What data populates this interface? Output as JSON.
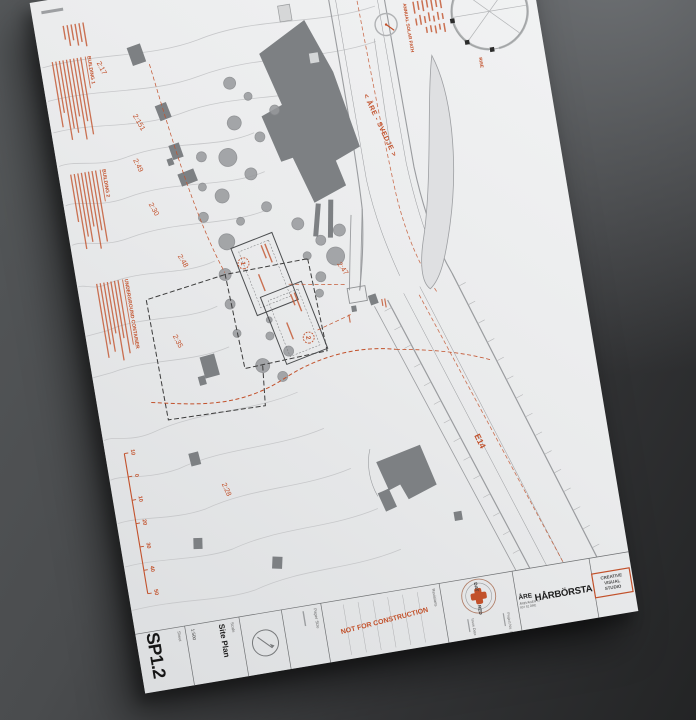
{
  "sheet": {
    "studio_stamp_line1": "CREATIVE",
    "studio_stamp_line2": "VISUAL",
    "studio_stamp_line3": "STUDIO",
    "project_city": "ÅRE",
    "project_name": "HÅRBÖRSTA",
    "address_line1": "ÅREVÄGEN 57",
    "address_line2": "837 52 ÅRE",
    "logo_left": "DAT",
    "logo_right": "RED",
    "project_no_label": "Project No. 1",
    "issue_date_label": "Issue Date",
    "revisions_label": "Revisions",
    "construction_stamp": "NOT FOR CONSTRUCTION",
    "paper_size_label": "Paper Size",
    "scale_label": "Scale",
    "sheet_title": "Site Plan",
    "scale_value": "1:500",
    "sheet_label": "Sheet",
    "sheet_number": "SP1.2"
  },
  "map": {
    "highway_label": "E14",
    "road_label": "< ÅRE - SVEDJE >",
    "solar_caption": "ANNUAL SOLAR PATH",
    "rise_label": "RISE",
    "parcels": [
      "2:17",
      "2:151",
      "2:49",
      "2:30",
      "2:48",
      "2:35",
      "2:47",
      "2:28"
    ],
    "notes": [
      "BUILDING 1",
      "BUILDING 2",
      "UNDERGROUND CONTAINER"
    ],
    "plot_numbers": [
      "1",
      "2"
    ],
    "scale_ticks": [
      "10",
      "0",
      "10",
      "20",
      "30",
      "40",
      "50"
    ]
  },
  "colors": {
    "accent": "#c2512b",
    "paper": "#eaebec",
    "background": "#3a3c3e",
    "building_gray": "#7d8083"
  }
}
